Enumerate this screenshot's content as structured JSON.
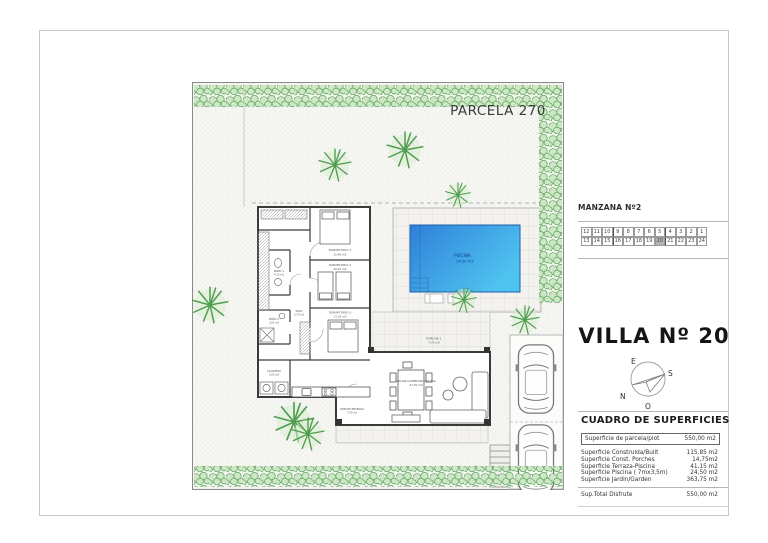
{
  "page": {
    "parcela_label": "PARCELA 270"
  },
  "manzana": {
    "title": "MANZANA Nº2",
    "row1": [
      "12",
      "11",
      "10",
      "9",
      "8",
      "7",
      "6",
      "5",
      "4",
      "3",
      "2",
      "1"
    ],
    "row2": [
      "13",
      "14",
      "15",
      "16",
      "17",
      "18",
      "19",
      "20",
      "21",
      "22",
      "23",
      "24"
    ],
    "highlighted": "20"
  },
  "villa": {
    "title": "VILLA Nº 20"
  },
  "compass": {
    "east": "E",
    "south": "S",
    "north": "N",
    "west": "O"
  },
  "cuadro": {
    "title": "CUADRO DE SUPERFICIES",
    "plot_row": {
      "label": "Superficie de parcela/plot",
      "value": "550,00 m2"
    },
    "rows": [
      {
        "label": "Superficie Construida/Built",
        "value": "115,85 m2"
      },
      {
        "label": "Superficie Const. Porches",
        "value": "14,75m2"
      },
      {
        "label": "Superficie Terraza-Piscina",
        "value": "41,15 m2"
      },
      {
        "label": "Superficie Piscina ( 7mx3,5m)",
        "value": "24,50 m2"
      },
      {
        "label": "Superficie Jardin/Garden",
        "value": "363,75 m2"
      }
    ],
    "total_row": {
      "label": "Sup.Total Disfrute",
      "value": "550,00 m2"
    }
  },
  "plan": {
    "pool": {
      "name": "PISCINA",
      "area": "24,50 m2"
    },
    "rooms": [
      {
        "name": "DORMITORIO 1",
        "area": "15,40 m2"
      },
      {
        "name": "DORMITORIO 2",
        "area": "10,25 m2"
      },
      {
        "name": "DORMITORIO 3",
        "area": "13,35 m2"
      },
      {
        "name": "BAÑO 1",
        "area": "4,10 m2"
      },
      {
        "name": "BAÑO 2",
        "area": "3,55 m2"
      },
      {
        "name": "PASO",
        "area": "3,70 m2"
      },
      {
        "name": "LAVADERO",
        "area": "2,60 m2"
      },
      {
        "name": "SALON-COMEDOR-COCINA",
        "area": "41,55 m2"
      },
      {
        "name": "PORCHE 1",
        "area": "7,75 m2"
      },
      {
        "name": "PORCHE ENTRADA",
        "area": "7,00 m2"
      }
    ]
  },
  "colors": {
    "pool_start": "#2f80d8",
    "pool_end": "#4fc3f0",
    "green": "#4e9e4e",
    "rule_gray": "#b5b5b5"
  }
}
